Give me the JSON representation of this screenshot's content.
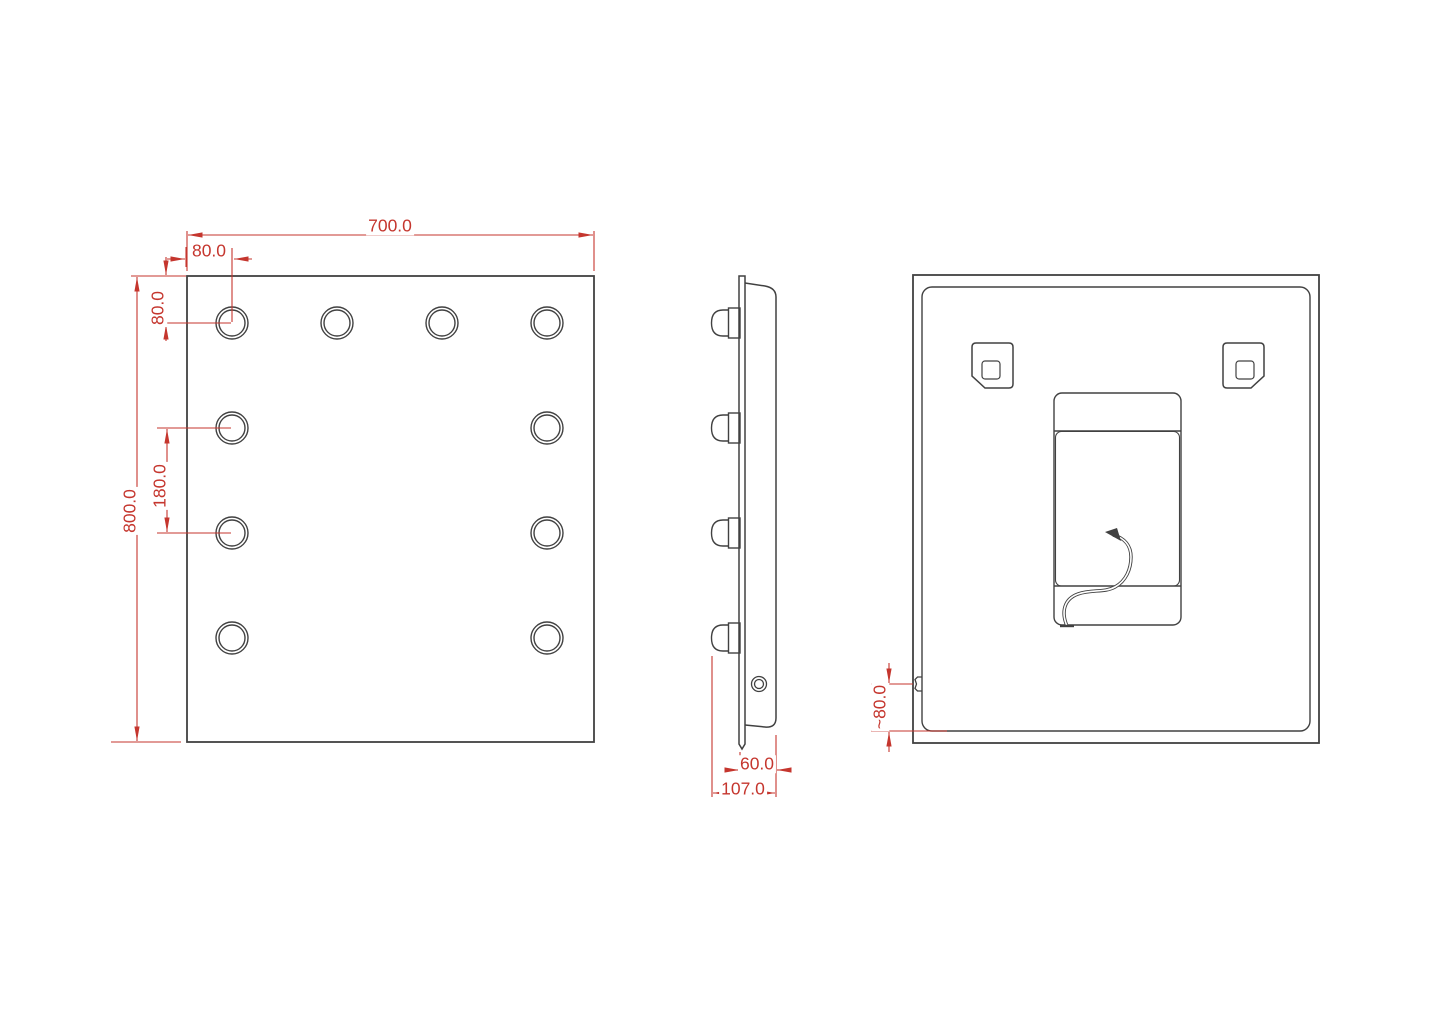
{
  "drawing": {
    "type": "technical-drawing",
    "subject": "illuminated mirror - three orthographic views",
    "colors": {
      "line": "#414141",
      "dimension": "#c5362e",
      "background": "#ffffff"
    },
    "views": {
      "front": {
        "name": "front view",
        "hole_count": 10,
        "dims": {
          "width": "700.0",
          "hole_inset_x": "80.0",
          "hole_inset_y": "80.0",
          "hole_pitch": "180.0",
          "height": "800.0"
        }
      },
      "side": {
        "name": "side view",
        "bulb_count": 4,
        "dims": {
          "body_depth": "60.0",
          "total_depth": "107.0"
        }
      },
      "back": {
        "name": "back view",
        "bracket_count": 2,
        "dims": {
          "switch_height": "~80.0"
        }
      }
    }
  }
}
